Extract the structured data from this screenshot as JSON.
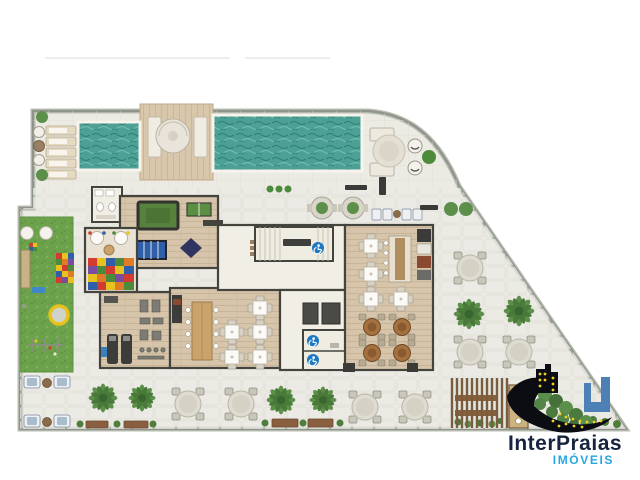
{
  "logo": {
    "name": "InterPraias",
    "tagline": "IMÓVEIS"
  },
  "colors": {
    "brand-navy": "#17243f",
    "brand-blue": "#28a7de",
    "icon-black": "#0c0d12",
    "icon-blue": "#4d80b4",
    "icon-yellow": "#f2cf1f",
    "water": "#4da096",
    "water-dark": "#2b7f72",
    "grass": "#6ca24c",
    "deck-wood": "#d8c7ab",
    "room-wood": "#d6c5aa",
    "paving": "#ecebe3",
    "site-border": "#8e948a",
    "wall": "#44443f",
    "access-blue": "#1d79c2",
    "pool-table-green": "#57823e",
    "foosball-blue": "#2f5fa8"
  },
  "features": [
    "main-pool",
    "kids-pool",
    "sun-deck",
    "lounge-deck",
    "playground-lawn",
    "games-room",
    "kids-playroom",
    "gym",
    "gourmet-room",
    "party-hall",
    "stairs",
    "elevators",
    "accessible-wc",
    "terrace-tables",
    "palm-trees",
    "benches",
    "fence-gate",
    "hedge"
  ]
}
